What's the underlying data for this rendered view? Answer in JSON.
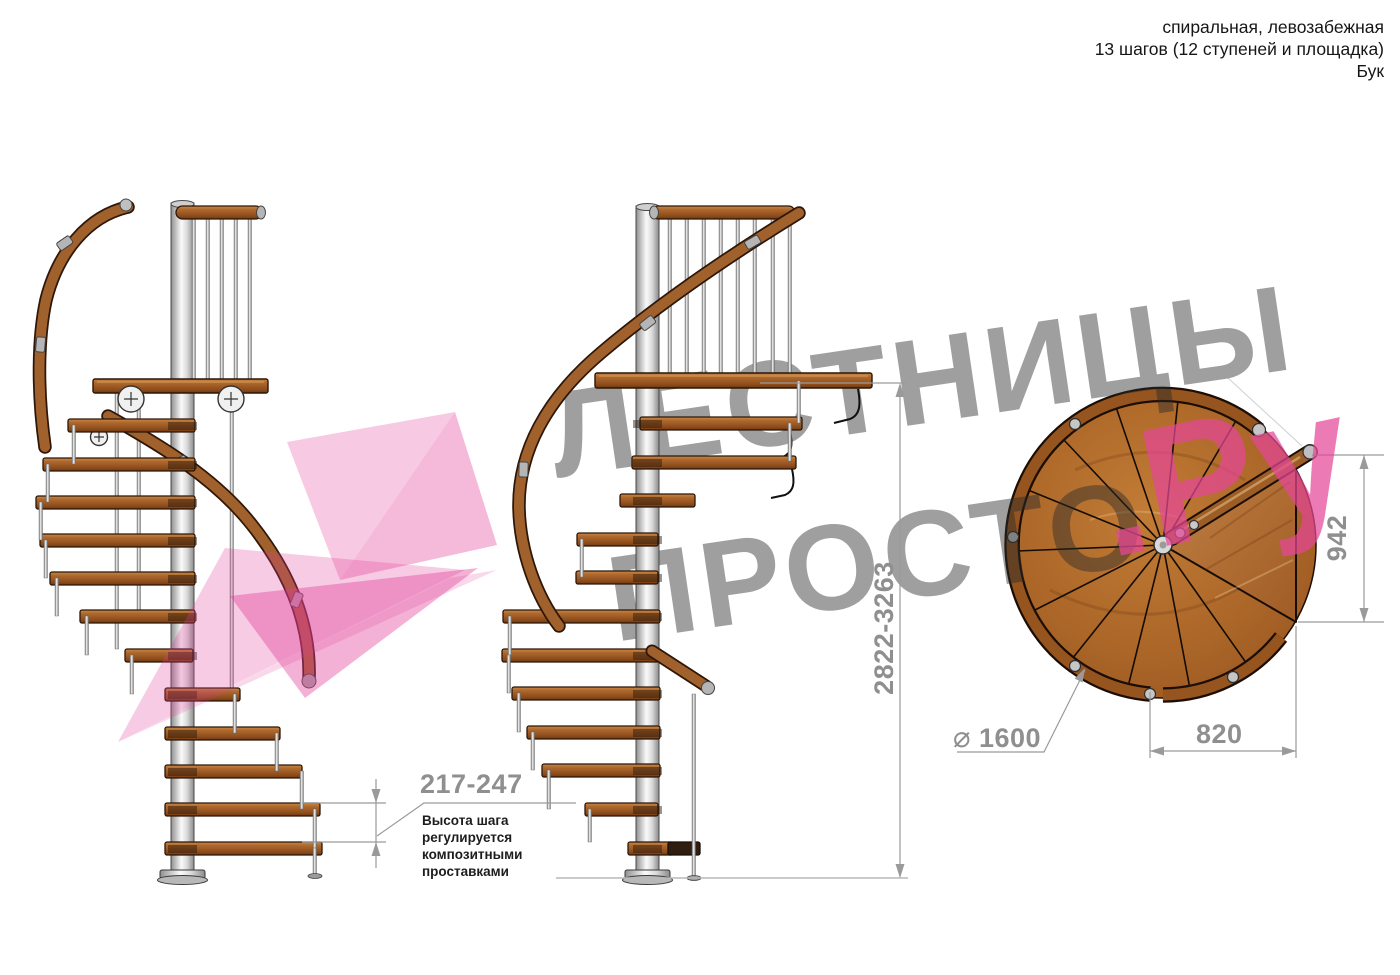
{
  "header": {
    "line1": "спиральная, левозабежная",
    "line2": "13 шагов (12 ступеней и площадка)",
    "line3": "Бук"
  },
  "watermark": {
    "brand_top": "ЛЕСТНИЦЫ",
    "brand_bottom": "ПРОСТО",
    "brand_suffix": ".Ру"
  },
  "dimensions": {
    "step_height": {
      "value": "217-247",
      "note_lines": [
        "Высота шага",
        "регулируется",
        "композитными",
        "проставками"
      ]
    },
    "total_height": {
      "value": "2822-3263"
    },
    "platform_height": {
      "value": "942"
    },
    "platform_width": {
      "value": "820"
    },
    "diameter": {
      "symbol": "⌀",
      "value": "1600"
    }
  },
  "colors": {
    "wood": "#a0612c",
    "wood_dark": "#6e3710",
    "pole_metal": "#d9d9d9",
    "dimension_gray": "#8f8f8f",
    "watermark_gray": "#9a9a9a",
    "watermark_pink": "#e8459a",
    "note_text": "#1d1d1d"
  }
}
